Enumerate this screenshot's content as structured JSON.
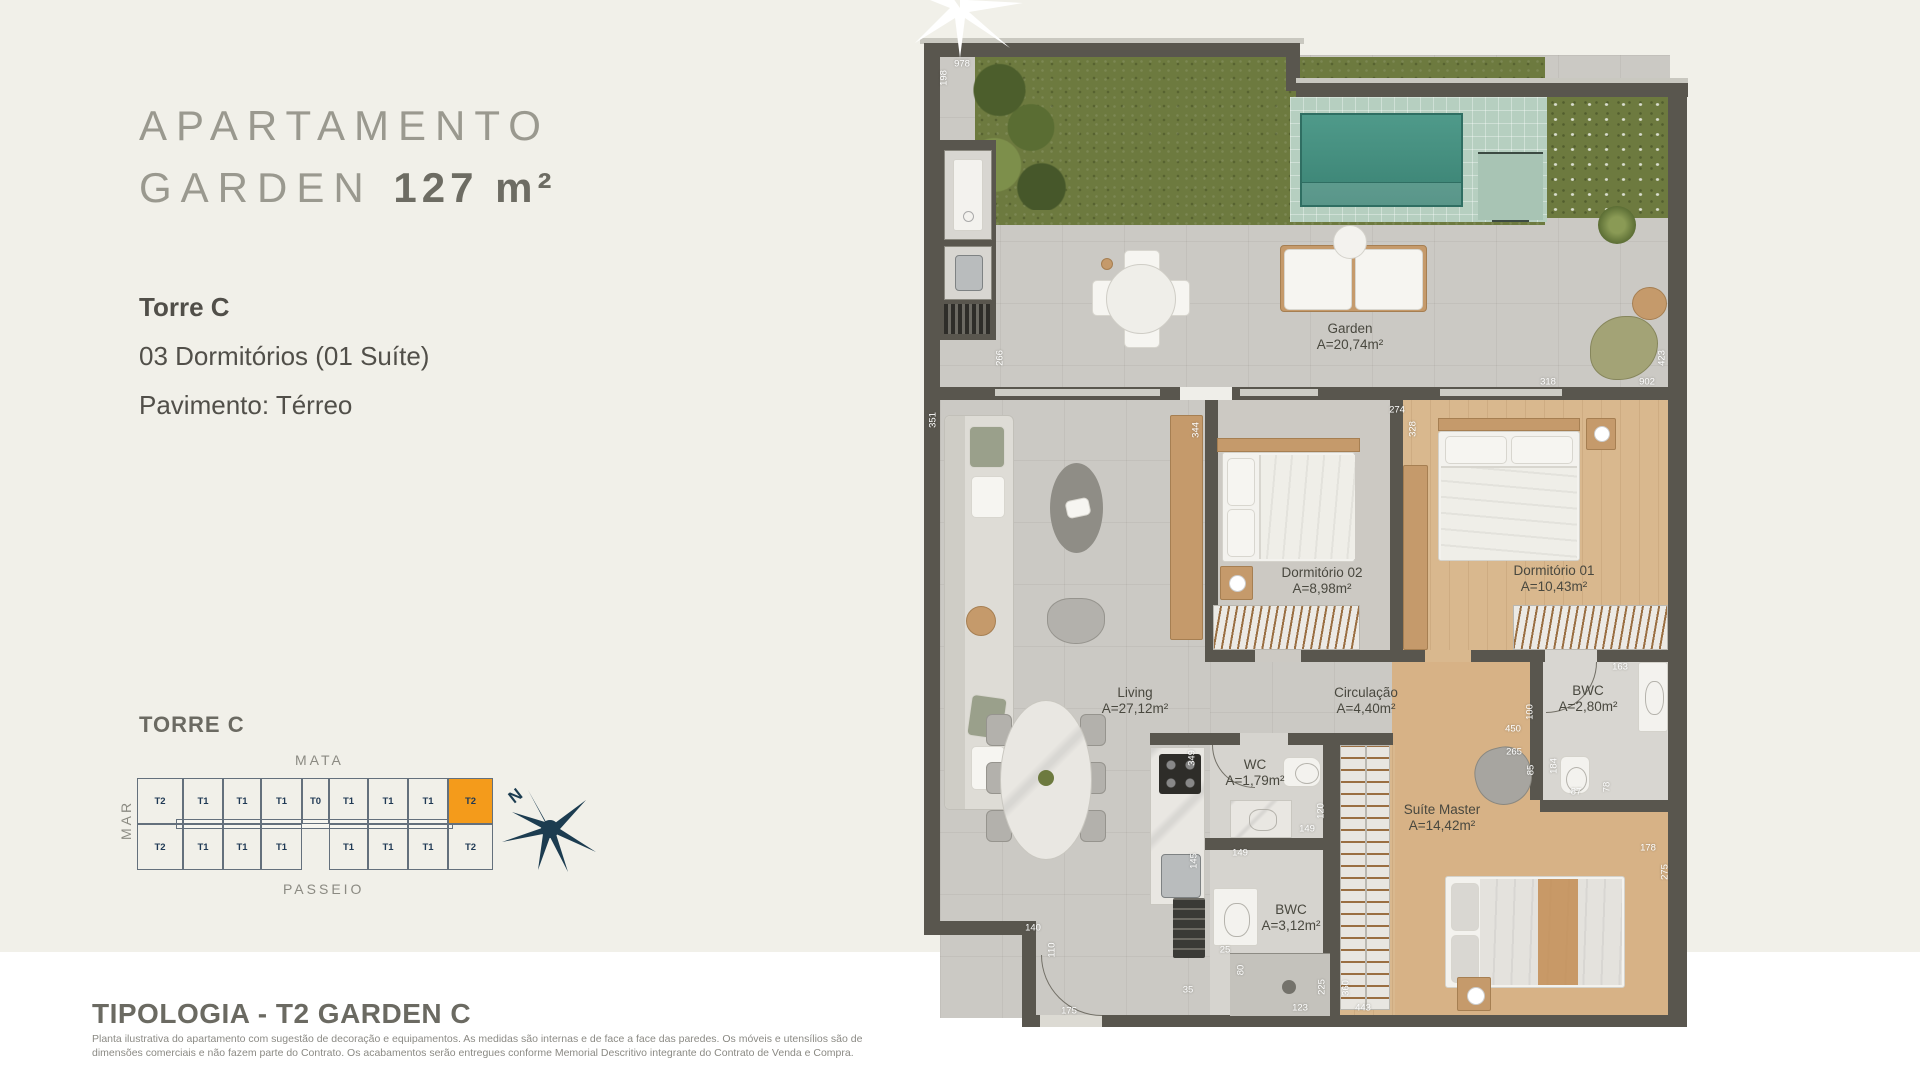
{
  "colors": {
    "background": "#f1f0e9",
    "bottom_strip": "#ffffff",
    "accent_orange": "#f49b1b",
    "compass_navy": "#1c3c50",
    "wall": "#59564e",
    "pool_water": "#47917f"
  },
  "left_panel": {
    "title_line1": "APARTAMENTO",
    "title_line2_light": "GARDEN ",
    "title_line2_bold": "127 m²",
    "tower": "Torre C",
    "spec_line1": "03 Dormitórios (01 Suíte)",
    "spec_line2": "Pavimento: Térreo"
  },
  "tower_map": {
    "title": "TORRE C",
    "label_top": "MATA",
    "label_left": "MAR",
    "label_bottom": "PASSEIO",
    "row_top": [
      "T2",
      "T1",
      "T1",
      "T1",
      "T0",
      "T1",
      "T1",
      "T1",
      "T2"
    ],
    "row_bottom": [
      "T2",
      "T1",
      "T1",
      "T1",
      "",
      "T1",
      "T1",
      "T1",
      "T2"
    ],
    "highlighted_row": "top",
    "highlighted_index": 8,
    "highlighted_unit": "T2",
    "compass_letter": "N"
  },
  "footer": {
    "heading": "TIPOLOGIA - T2 GARDEN C",
    "disclaimer_line1": "Planta ilustrativa do apartamento com sugestão de decoração e equipamentos. As medidas são internas e de face a face das paredes. Os móveis e utensílios são de",
    "disclaimer_line2": "dimensões comerciais e não fazem parte do Contrato. Os acabamentos serão entregues conforme Memorial Descritivo integrante do Contrato de Venda e Compra."
  },
  "floor_plan": {
    "rooms": {
      "garden": {
        "name": "Garden",
        "area": "A=20,74m²"
      },
      "living": {
        "name": "Living",
        "area": "A=27,12m²"
      },
      "dorm2": {
        "name": "Dormitório 02",
        "area": "A=8,98m²"
      },
      "dorm1": {
        "name": "Dormitório 01",
        "area": "A=10,43m²"
      },
      "circulacao": {
        "name": "Circulação",
        "area": "A=4,40m²"
      },
      "bwc1": {
        "name": "BWC",
        "area": "A=2,80m²"
      },
      "wc": {
        "name": "WC",
        "area": "A=1,79m²"
      },
      "suite": {
        "name": "Suíte Master",
        "area": "A=14,42m²"
      },
      "bwc2": {
        "name": "BWC",
        "area": "A=3,12m²"
      }
    },
    "dims": [
      {
        "t": "978",
        "x": 962,
        "y": 64
      },
      {
        "t": "198",
        "x": 944,
        "y": 78,
        "v": true
      },
      {
        "t": "266",
        "x": 1000,
        "y": 358,
        "v": true
      },
      {
        "t": "351",
        "x": 933,
        "y": 420,
        "v": true
      },
      {
        "t": "344",
        "x": 1196,
        "y": 430,
        "v": true
      },
      {
        "t": "274",
        "x": 1397,
        "y": 410
      },
      {
        "t": "328",
        "x": 1413,
        "y": 429,
        "v": true
      },
      {
        "t": "318",
        "x": 1548,
        "y": 382
      },
      {
        "t": "902",
        "x": 1647,
        "y": 382
      },
      {
        "t": "423",
        "x": 1662,
        "y": 358,
        "v": true
      },
      {
        "t": "349",
        "x": 1192,
        "y": 758,
        "v": true
      },
      {
        "t": "100",
        "x": 1530,
        "y": 712,
        "v": true
      },
      {
        "t": "450",
        "x": 1513,
        "y": 729
      },
      {
        "t": "265",
        "x": 1514,
        "y": 752
      },
      {
        "t": "85",
        "x": 1531,
        "y": 770,
        "v": true
      },
      {
        "t": "184",
        "x": 1554,
        "y": 766,
        "v": true
      },
      {
        "t": "163",
        "x": 1620,
        "y": 667
      },
      {
        "t": "87",
        "x": 1576,
        "y": 792
      },
      {
        "t": "78",
        "x": 1607,
        "y": 787,
        "v": true
      },
      {
        "t": "120",
        "x": 1321,
        "y": 811,
        "v": true
      },
      {
        "t": "149",
        "x": 1307,
        "y": 829
      },
      {
        "t": "149",
        "x": 1240,
        "y": 853
      },
      {
        "t": "145",
        "x": 1194,
        "y": 861,
        "v": true
      },
      {
        "t": "25",
        "x": 1225,
        "y": 950
      },
      {
        "t": "80",
        "x": 1241,
        "y": 970,
        "v": true
      },
      {
        "t": "123",
        "x": 1300,
        "y": 1008
      },
      {
        "t": "225",
        "x": 1322,
        "y": 987,
        "v": true
      },
      {
        "t": "360",
        "x": 1346,
        "y": 988,
        "v": true
      },
      {
        "t": "443",
        "x": 1363,
        "y": 1008
      },
      {
        "t": "35",
        "x": 1188,
        "y": 990
      },
      {
        "t": "140",
        "x": 1033,
        "y": 928
      },
      {
        "t": "110",
        "x": 1052,
        "y": 950,
        "v": true
      },
      {
        "t": "175",
        "x": 1069,
        "y": 1011
      },
      {
        "t": "178",
        "x": 1648,
        "y": 848
      },
      {
        "t": "275",
        "x": 1665,
        "y": 872,
        "v": true
      }
    ]
  }
}
